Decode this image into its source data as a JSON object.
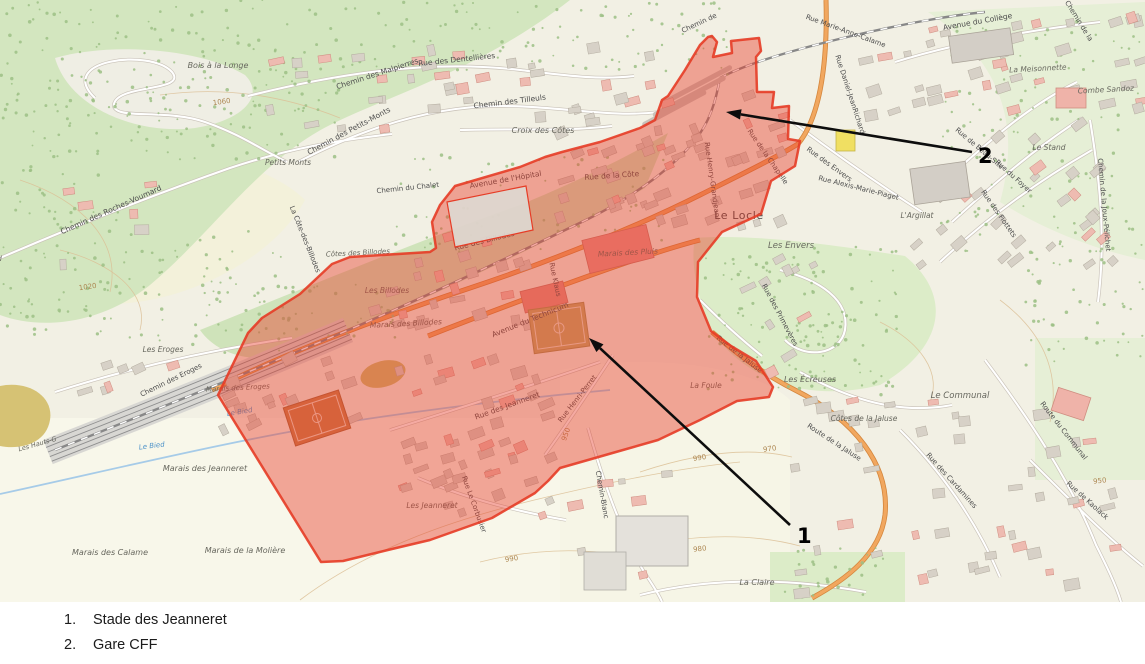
{
  "legend": {
    "items": [
      {
        "num": "1.",
        "label": "Stade des Jeanneret"
      },
      {
        "num": "2.",
        "label": "Gare CFF"
      }
    ]
  },
  "annotations": {
    "markers": [
      {
        "label": "1",
        "from": [
          790,
          525
        ],
        "to": [
          589,
          338
        ],
        "label_pos": [
          797,
          543
        ]
      },
      {
        "label": "2",
        "from": [
          972,
          152
        ],
        "to": [
          726,
          112
        ],
        "label_pos": [
          978,
          163
        ]
      }
    ]
  },
  "colors": {
    "overlay_fill": "#e93e2c",
    "overlay_opacity": 0.44,
    "overlay_stroke": "#e63c26",
    "arrow": "#0d0d0d",
    "legend_text": "#1c1c1c",
    "map_background": "#f2f0e4",
    "forest_green": "#d3e6bf",
    "water_blue": "#a6cbe8",
    "road_orange": "#f1a75f",
    "contour_tan": "#ad8752"
  },
  "map": {
    "town_label": "Le Locle",
    "labels": [
      {
        "t": "Bois à la Longe",
        "x": 218,
        "y": 68,
        "r": 0,
        "s": 8,
        "c": "place"
      },
      {
        "t": "Chemin des Malpierres",
        "x": 378,
        "y": 76,
        "r": -18,
        "s": 7.5,
        "c": "lbl"
      },
      {
        "t": "Rue des Dentellières",
        "x": 457,
        "y": 62,
        "r": -6,
        "s": 7.5,
        "c": "lbl"
      },
      {
        "t": "Chemin des Tilleuls",
        "x": 510,
        "y": 104,
        "r": -7,
        "s": 7.5,
        "c": "lbl"
      },
      {
        "t": "Chemin des Petits-Monts",
        "x": 350,
        "y": 133,
        "r": -28,
        "s": 7.5,
        "c": "lbl"
      },
      {
        "t": "Croix des Côtes",
        "x": 543,
        "y": 133,
        "r": 0,
        "s": 8,
        "c": "place"
      },
      {
        "t": "Petits Monts",
        "x": 288,
        "y": 165,
        "r": 0,
        "s": 7.5,
        "c": "place"
      },
      {
        "t": "Chemin des Roches-Voumard",
        "x": 112,
        "y": 212,
        "r": -24,
        "s": 7.5,
        "c": "lbl"
      },
      {
        "t": "Voumard",
        "x": -14,
        "y": 261,
        "r": 0,
        "s": 7,
        "c": "place"
      },
      {
        "t": "Chemin du Chalet",
        "x": 408,
        "y": 190,
        "r": -6,
        "s": 7,
        "c": "lbl"
      },
      {
        "t": "La Côte-des-Billodes",
        "x": 303,
        "y": 240,
        "r": 68,
        "s": 7,
        "c": "lbl"
      },
      {
        "t": "Avenue de l'Hôpital",
        "x": 506,
        "y": 182,
        "r": -10,
        "s": 7.5,
        "c": "lbl"
      },
      {
        "t": "Rue de la Côte",
        "x": 612,
        "y": 178,
        "r": -4,
        "s": 7.5,
        "c": "lbl"
      },
      {
        "t": "Rue des Billodes",
        "x": 485,
        "y": 243,
        "r": -14,
        "s": 7.5,
        "c": "lbl"
      },
      {
        "t": "Les Billodes",
        "x": 387,
        "y": 293,
        "r": 0,
        "s": 7.5,
        "c": "place"
      },
      {
        "t": "Marais des Billodes",
        "x": 406,
        "y": 326,
        "r": -3,
        "s": 7.5,
        "c": "place"
      },
      {
        "t": "Côtes des Billodes",
        "x": 358,
        "y": 255,
        "r": -3,
        "s": 7,
        "c": "place"
      },
      {
        "t": "Avenue du Technicum",
        "x": 531,
        "y": 322,
        "r": -22,
        "s": 7.5,
        "c": "lbl"
      },
      {
        "t": "Rue Klaus",
        "x": 553,
        "y": 280,
        "r": 78,
        "s": 7,
        "c": "lbl"
      },
      {
        "t": "Marais des Pluis",
        "x": 628,
        "y": 255,
        "r": -3,
        "s": 7.5,
        "c": "place"
      },
      {
        "t": "Le Locle",
        "x": 739,
        "y": 219,
        "r": 0,
        "s": 11,
        "c": "town"
      },
      {
        "t": "Rue des Jeanneret",
        "x": 508,
        "y": 408,
        "r": -20,
        "s": 7.5,
        "c": "lbl"
      },
      {
        "t": "Rue Henri-Perret",
        "x": 579,
        "y": 400,
        "r": -52,
        "s": 7,
        "c": "lbl"
      },
      {
        "t": "Les Jeanneret",
        "x": 432,
        "y": 508,
        "r": 0,
        "s": 7.5,
        "c": "place"
      },
      {
        "t": "Rue Le Corbusier",
        "x": 472,
        "y": 505,
        "r": 70,
        "s": 7,
        "c": "lbl"
      },
      {
        "t": "Chemin-Blanc",
        "x": 600,
        "y": 495,
        "r": 80,
        "s": 7,
        "c": "lbl"
      },
      {
        "t": "La Foule",
        "x": 706,
        "y": 388,
        "r": 0,
        "s": 7.5,
        "c": "place"
      },
      {
        "t": "Les Envers",
        "x": 791,
        "y": 248,
        "r": 0,
        "s": 8.5,
        "c": "place"
      },
      {
        "t": "Rue des Primevères",
        "x": 778,
        "y": 316,
        "r": 62,
        "s": 7,
        "c": "lbl"
      },
      {
        "t": "Rue de la Jaluse",
        "x": 738,
        "y": 356,
        "r": 38,
        "s": 7,
        "c": "lbl"
      },
      {
        "t": "Les Écreuses",
        "x": 810,
        "y": 382,
        "r": 0,
        "s": 8,
        "c": "place"
      },
      {
        "t": "Côtes de la Jaluse",
        "x": 864,
        "y": 421,
        "r": 0,
        "s": 7.5,
        "c": "place"
      },
      {
        "t": "Route de la Jaluse",
        "x": 833,
        "y": 444,
        "r": 33,
        "s": 7,
        "c": "lbl"
      },
      {
        "t": "Le Communal",
        "x": 960,
        "y": 398,
        "r": 0,
        "s": 8.5,
        "c": "place"
      },
      {
        "t": "Route du Communal",
        "x": 1062,
        "y": 432,
        "r": 52,
        "s": 7,
        "c": "lbl"
      },
      {
        "t": "Rue des Cardamines",
        "x": 950,
        "y": 482,
        "r": 48,
        "s": 7,
        "c": "lbl"
      },
      {
        "t": "Rue de Kaolack",
        "x": 1086,
        "y": 502,
        "r": 42,
        "s": 7,
        "c": "lbl"
      },
      {
        "t": "La Claire",
        "x": 757,
        "y": 585,
        "r": 0,
        "s": 8,
        "c": "place"
      },
      {
        "t": "Marais des Jeanneret",
        "x": 205,
        "y": 471,
        "r": 0,
        "s": 8,
        "c": "place"
      },
      {
        "t": "Marais de la Molière",
        "x": 245,
        "y": 553,
        "r": 0,
        "s": 8,
        "c": "place"
      },
      {
        "t": "Marais des Calame",
        "x": 110,
        "y": 555,
        "r": 0,
        "s": 8,
        "c": "place"
      },
      {
        "t": "Les Eroges",
        "x": 163,
        "y": 352,
        "r": 0,
        "s": 7.5,
        "c": "place"
      },
      {
        "t": "Chemin des Eroges",
        "x": 172,
        "y": 382,
        "r": -26,
        "s": 7,
        "c": "lbl"
      },
      {
        "t": "Marais des Eroges",
        "x": 238,
        "y": 390,
        "r": -3,
        "s": 7,
        "c": "place"
      },
      {
        "t": "Les Hauts-G",
        "x": 38,
        "y": 446,
        "r": -16,
        "s": 6.5,
        "c": "place"
      },
      {
        "t": "Le Bied",
        "x": 152,
        "y": 448,
        "r": -7,
        "s": 7,
        "c": "water-lbl"
      },
      {
        "t": "Le Bied",
        "x": 240,
        "y": 414,
        "r": -9,
        "s": 7,
        "c": "water-lbl"
      },
      {
        "t": "Rue Marie-Anne-Calame",
        "x": 845,
        "y": 33,
        "r": 20,
        "s": 7,
        "c": "lbl"
      },
      {
        "t": "Rue Daniel-JeanRichard",
        "x": 848,
        "y": 95,
        "r": 72,
        "s": 7,
        "c": "lbl"
      },
      {
        "t": "Rue des Envers",
        "x": 828,
        "y": 166,
        "r": 36,
        "s": 7,
        "c": "lbl"
      },
      {
        "t": "Rue Alexis-Marie-Piaget",
        "x": 858,
        "y": 190,
        "r": 14,
        "s": 7,
        "c": "lbl"
      },
      {
        "t": "Rue Henry-Grandjean",
        "x": 710,
        "y": 180,
        "r": 82,
        "s": 7,
        "c": "lbl"
      },
      {
        "t": "Rue de la Chapelle",
        "x": 766,
        "y": 158,
        "r": 55,
        "s": 7,
        "c": "lbl"
      },
      {
        "t": "Chemin de",
        "x": 700,
        "y": 25,
        "r": -25,
        "s": 7,
        "c": "lbl"
      },
      {
        "t": "Avenue du Collège",
        "x": 978,
        "y": 24,
        "r": -10,
        "s": 7.5,
        "c": "lbl"
      },
      {
        "t": "Chemin de la",
        "x": 1077,
        "y": 22,
        "r": 58,
        "s": 7,
        "c": "lbl"
      },
      {
        "t": "La Meisonnette",
        "x": 1038,
        "y": 71,
        "r": -3,
        "s": 7.5,
        "c": "place"
      },
      {
        "t": "Combe Sandoz",
        "x": 1106,
        "y": 92,
        "r": -3,
        "s": 7.5,
        "c": "place"
      },
      {
        "t": "Chemin de la Joux-Pélichet",
        "x": 1102,
        "y": 205,
        "r": 85,
        "s": 7,
        "c": "lbl"
      },
      {
        "t": "Le Stand",
        "x": 1049,
        "y": 150,
        "r": 0,
        "s": 7.5,
        "c": "place"
      },
      {
        "t": "Rue de Beau-Site",
        "x": 978,
        "y": 150,
        "r": 40,
        "s": 7,
        "c": "lbl"
      },
      {
        "t": "Rue du Foyer",
        "x": 1012,
        "y": 178,
        "r": 42,
        "s": 7,
        "c": "lbl"
      },
      {
        "t": "Rue des Fiottets",
        "x": 997,
        "y": 215,
        "r": 55,
        "s": 7,
        "c": "lbl"
      },
      {
        "t": "L'Argillat",
        "x": 917,
        "y": 218,
        "r": 0,
        "s": 7.5,
        "c": "place"
      },
      {
        "t": "1060",
        "x": 222,
        "y": 104,
        "r": -8,
        "s": 7,
        "c": "contour-lbl"
      },
      {
        "t": "1020",
        "x": 88,
        "y": 289,
        "r": -8,
        "s": 7,
        "c": "contour-lbl"
      },
      {
        "t": "950",
        "x": 568,
        "y": 435,
        "r": -70,
        "s": 7,
        "c": "contour-lbl"
      },
      {
        "t": "990",
        "x": 512,
        "y": 561,
        "r": -10,
        "s": 7,
        "c": "contour-lbl"
      },
      {
        "t": "990",
        "x": 700,
        "y": 460,
        "r": -10,
        "s": 7,
        "c": "contour-lbl"
      },
      {
        "t": "970",
        "x": 770,
        "y": 451,
        "r": -8,
        "s": 7,
        "c": "contour-lbl"
      },
      {
        "t": "980",
        "x": 700,
        "y": 551,
        "r": -6,
        "s": 7,
        "c": "contour-lbl"
      },
      {
        "t": "950",
        "x": 1100,
        "y": 483,
        "r": -6,
        "s": 7,
        "c": "contour-lbl"
      }
    ]
  }
}
